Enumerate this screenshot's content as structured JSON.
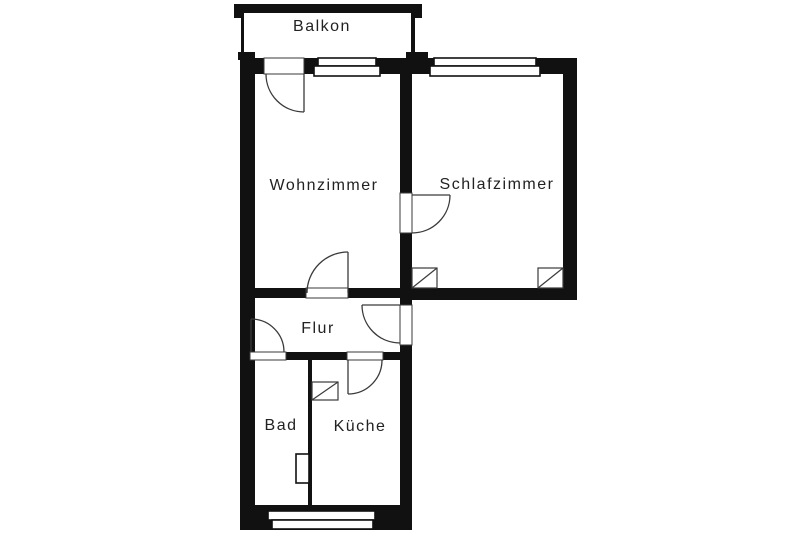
{
  "title": "Apartment floor plan",
  "colors": {
    "wall": "#111111",
    "line": "#3a3a3a",
    "text": "#222222",
    "background": "#ffffff"
  },
  "rooms": {
    "balkon": {
      "label": "Balkon"
    },
    "wohnzimmer": {
      "label": "Wohnzimmer"
    },
    "schlafzimmer": {
      "label": "Schlafzimmer"
    },
    "flur": {
      "label": "Flur"
    },
    "bad": {
      "label": "Bad"
    },
    "kueche": {
      "label": "Küche"
    }
  }
}
